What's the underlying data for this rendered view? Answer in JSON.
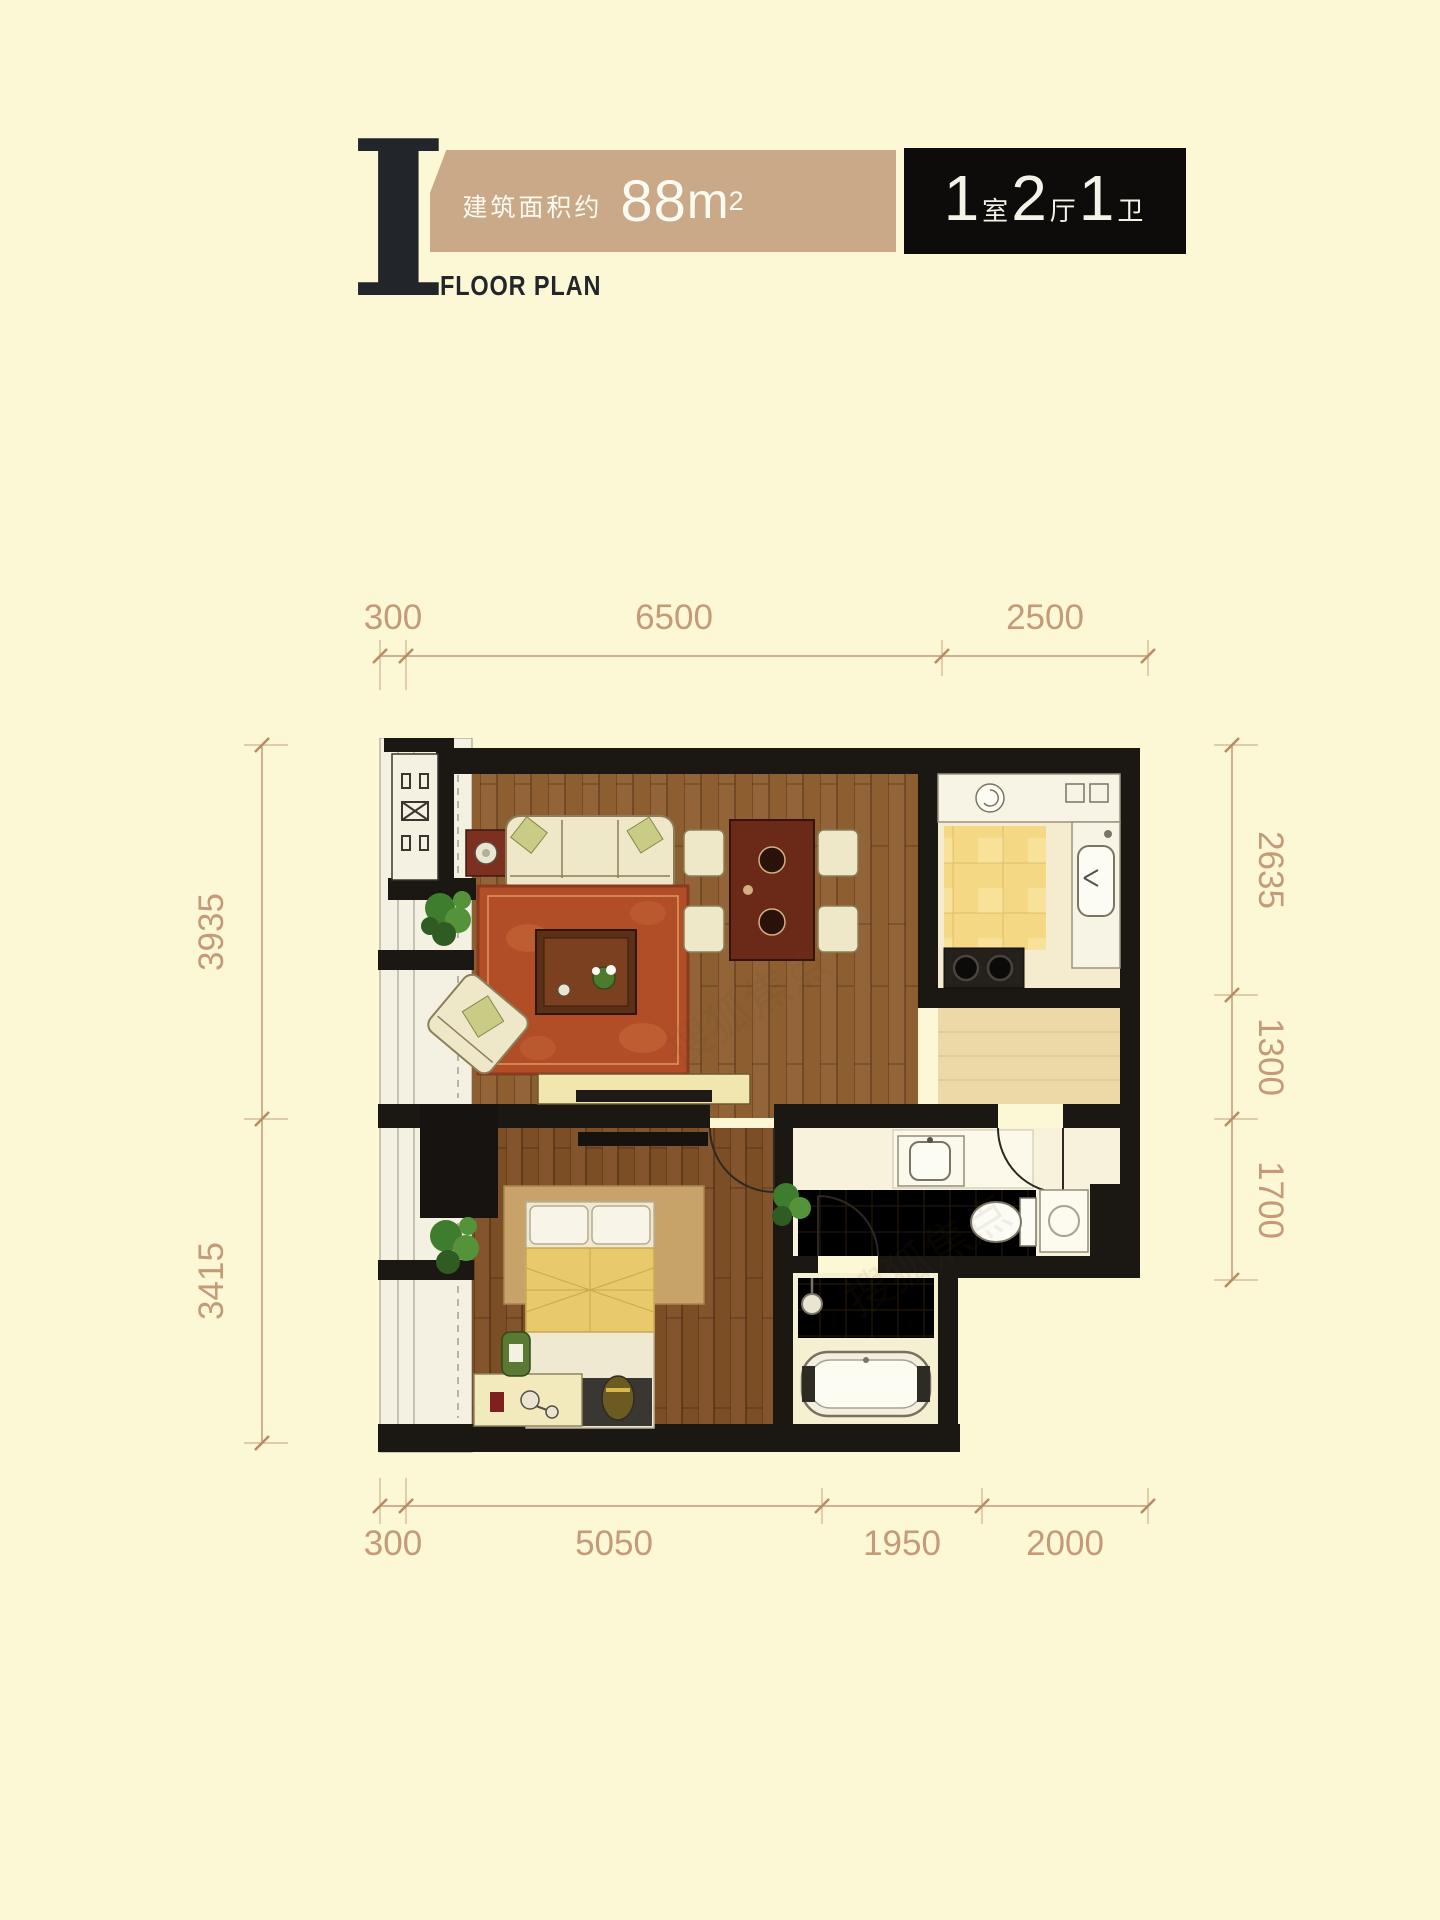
{
  "page": {
    "background": "#fcf8d5"
  },
  "header": {
    "roman_numeral": "I",
    "subtitle": "FLOOR PLAN",
    "area_prefix": "建筑面积约",
    "area_number": "88",
    "area_unit": "m",
    "area_exponent": "2",
    "layout_parts": [
      {
        "count": "1",
        "label": "室"
      },
      {
        "count": "2",
        "label": "厅"
      },
      {
        "count": "1",
        "label": "卫"
      }
    ],
    "accent_tan": "#c9a987",
    "accent_black": "#0d0c0a"
  },
  "floor_plan": {
    "dimensions_mm": {
      "top": [
        "300",
        "6500",
        "2500"
      ],
      "bottom": [
        "300",
        "5050",
        "1950",
        "2000"
      ],
      "left": [
        "3935",
        "3415"
      ],
      "right": [
        "2635",
        "1300",
        "1700"
      ]
    },
    "dimension_color": "#c49a78",
    "wall_color": "#1b1713",
    "watermark": "搜狐焦点"
  }
}
